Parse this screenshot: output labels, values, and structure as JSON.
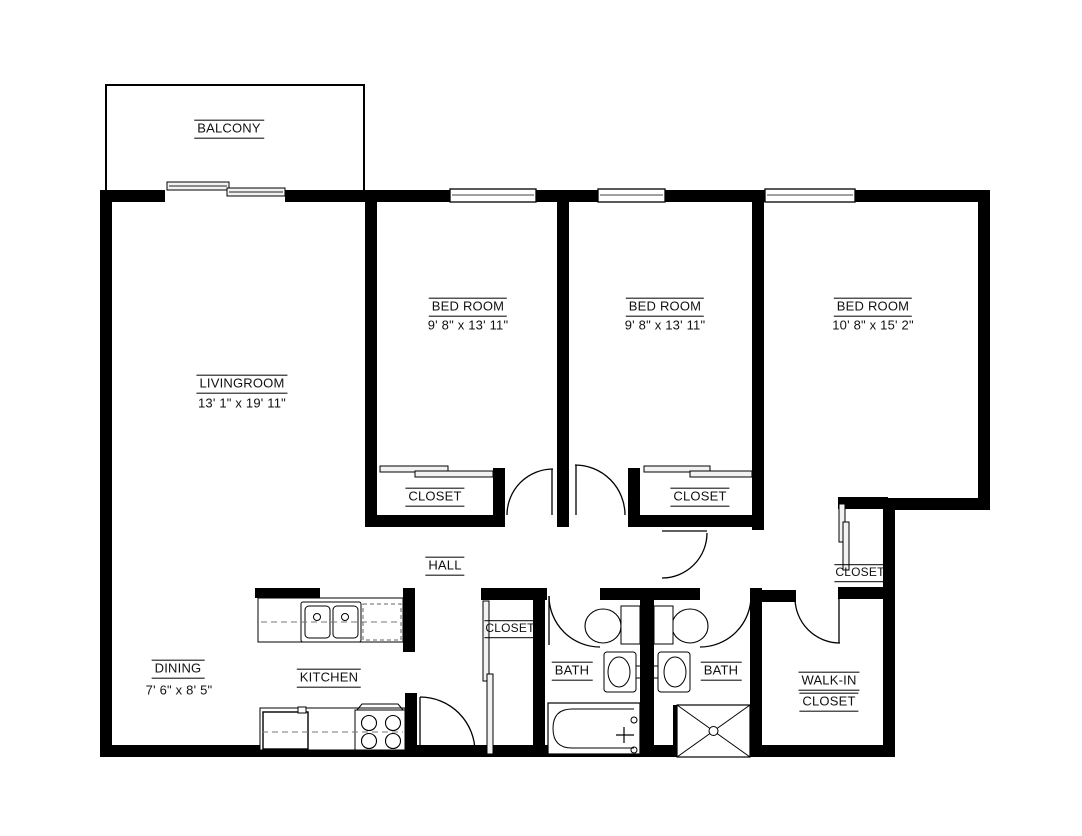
{
  "colors": {
    "wall": "#000000",
    "background": "#ffffff",
    "panel_fill": "#f2f2f2",
    "fixture_line": "#333333"
  },
  "rooms": {
    "balcony": {
      "label": "BALCONY"
    },
    "livingroom": {
      "label": "LIVINGROOM",
      "dimensions": "13' 1\" x 19' 11\""
    },
    "bedroom1": {
      "label": "BED ROOM",
      "dimensions": "9' 8\" x 13' 11\""
    },
    "bedroom2": {
      "label": "BED ROOM",
      "dimensions": "9' 8\" x 13' 11\""
    },
    "bedroom3": {
      "label": "BED ROOM",
      "dimensions": "10' 8\" x 15' 2\""
    },
    "closet_bedroom1": {
      "label": "CLOSET"
    },
    "closet_bedroom2": {
      "label": "CLOSET"
    },
    "closet_bedroom3": {
      "label": "CLOSET"
    },
    "hall": {
      "label": "HALL"
    },
    "hall_closet": {
      "label": "CLOSET"
    },
    "dining": {
      "label": "DINING",
      "dimensions": "7' 6\" x 8' 5\""
    },
    "kitchen": {
      "label": "KITCHEN"
    },
    "bath_left": {
      "label": "BATH"
    },
    "bath_right": {
      "label": "BATH"
    },
    "walkin_closet": {
      "line1": "WALK-IN",
      "line2": "CLOSET"
    }
  }
}
